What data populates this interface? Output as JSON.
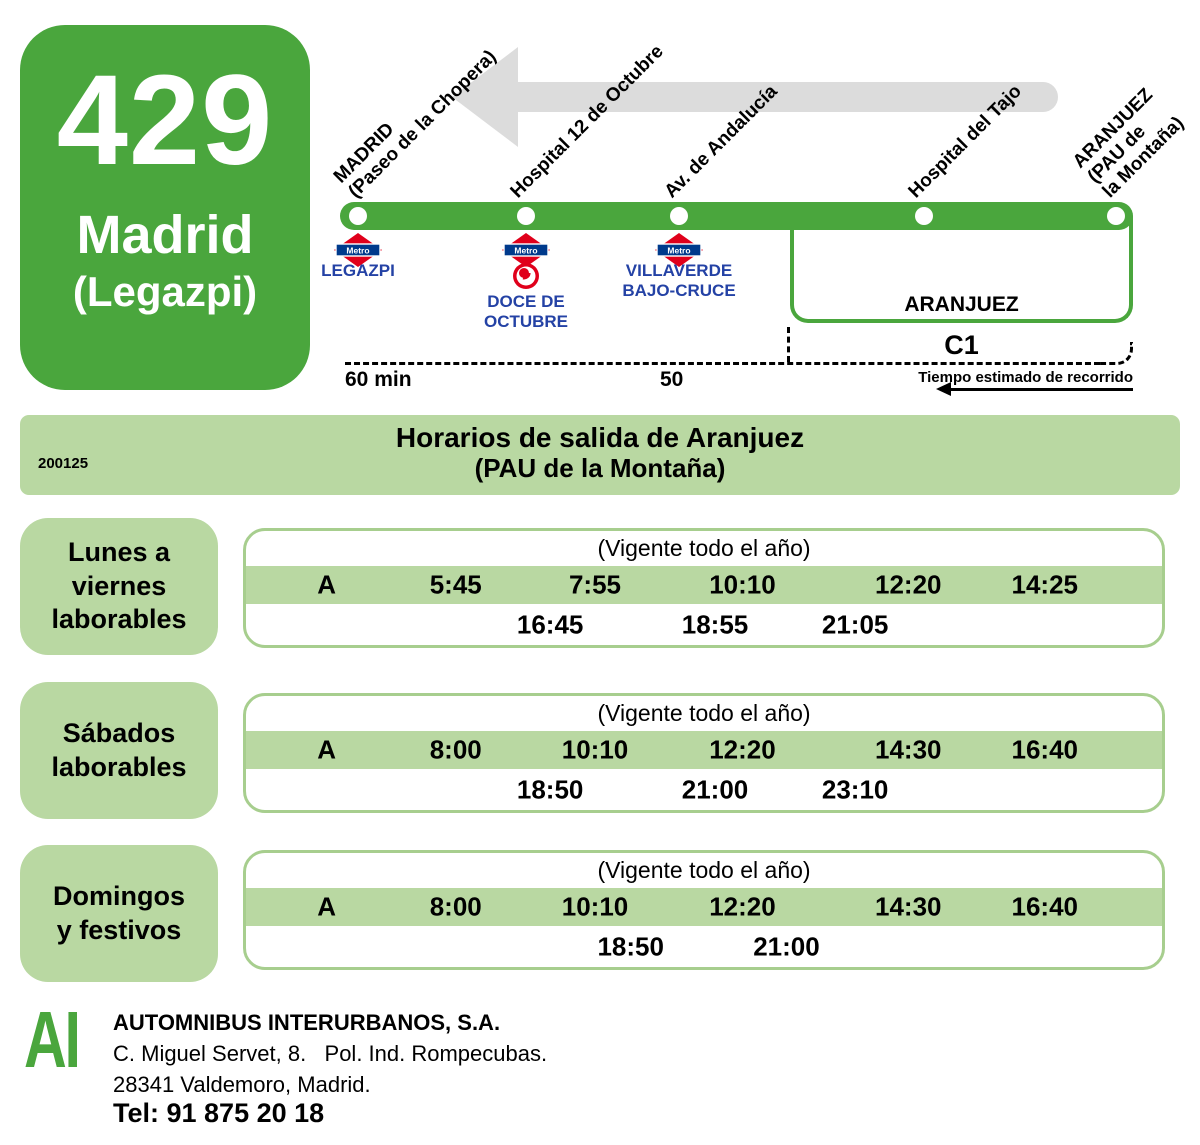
{
  "route_card": {
    "number": "429",
    "name": "Madrid",
    "subname": "(Legazpi)"
  },
  "diagram": {
    "metro_logo_text": "Metro",
    "stops": [
      {
        "label_lines": [
          "MADRID",
          "(Paseo de la Chopera)"
        ]
      },
      {
        "label_lines": [
          "Hospital 12 de Octubre"
        ]
      },
      {
        "label_lines": [
          "Av. de Andalucía"
        ]
      },
      {
        "label_lines": [
          "Hospital del Tajo"
        ]
      },
      {
        "label_lines": [
          "ARANJUEZ",
          "(PAU de",
          "la Montaña)"
        ]
      }
    ],
    "metro_stations": [
      {
        "lines": [
          "LEGAZPI"
        ]
      },
      {
        "lines": [
          "DOCE DE",
          "OCTUBRE"
        ]
      },
      {
        "lines": [
          "VILLAVERDE",
          "BAJO-CRUCE"
        ]
      }
    ],
    "bracket_label": "ARANJUEZ",
    "cercanias_label": "C1",
    "time_left": "60 min",
    "time_mid": "50",
    "estimated_caption": "Tiempo estimado de recorrido"
  },
  "banner": {
    "code": "200125",
    "title_line1": "Horarios de salida de Aranjuez",
    "title_line2": "(PAU de la Montaña)"
  },
  "schedules": [
    {
      "day_lines": [
        "Lunes a",
        "viernes",
        "laborables"
      ],
      "validity": "(Vigente todo el año)",
      "row1": [
        "A",
        "5:45",
        "7:55",
        "10:10",
        "12:20",
        "14:25"
      ],
      "row2": [
        "16:45",
        "18:55",
        "21:05"
      ]
    },
    {
      "day_lines": [
        "Sábados",
        "laborables"
      ],
      "validity": "(Vigente todo el año)",
      "row1": [
        "A",
        "8:00",
        "10:10",
        "12:20",
        "14:30",
        "16:40"
      ],
      "row2": [
        "18:50",
        "21:00",
        "23:10"
      ]
    },
    {
      "day_lines": [
        "Domingos",
        "y festivos"
      ],
      "validity": "(Vigente todo el año)",
      "row1": [
        "A",
        "8:00",
        "10:10",
        "12:20",
        "14:30",
        "16:40"
      ],
      "row2": [
        "18:50",
        "21:00"
      ]
    }
  ],
  "footer": {
    "logo": "AI",
    "company": "AUTOMNIBUS INTERURBANOS, S.A.",
    "address_line1": "C. Miguel Servet, 8.   Pol. Ind. Rompecubas.",
    "address_line2": "28341 Valdemoro, Madrid.",
    "phone": "Tel: 91 875 20 18"
  },
  "colors": {
    "green": "#4AA63D",
    "light_green": "#B9D8A2",
    "table_border": "#A7CE8E",
    "metro_red": "#E0001B",
    "metro_navy": "#003A8C",
    "station_blue": "#2442A5",
    "arrow_gray": "#DCDCDC"
  }
}
